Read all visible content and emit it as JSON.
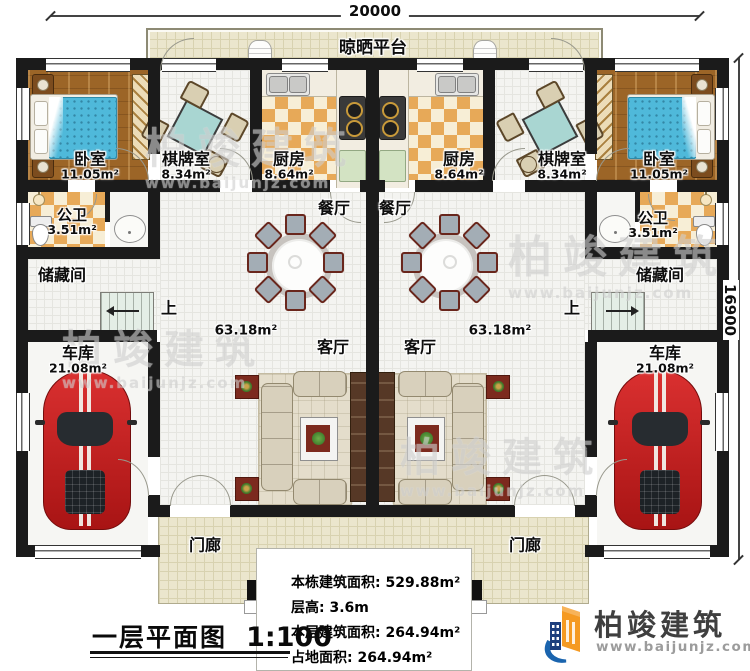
{
  "dimensions": {
    "top": "20000",
    "right": "16900"
  },
  "platform": {
    "label": "晾晒平台"
  },
  "rooms": {
    "bedroom": {
      "name": "卧室",
      "area": "11.05m²"
    },
    "chess": {
      "name": "棋牌室",
      "area": "8.34m²"
    },
    "kitchen": {
      "name": "厨房",
      "area": "8.64m²"
    },
    "bath": {
      "name": "公卫",
      "area": "3.51m²"
    },
    "storage": {
      "name": "储藏间"
    },
    "garage": {
      "name": "车库",
      "area": "21.08m²"
    },
    "dining": {
      "name": "餐厅"
    },
    "living": {
      "name": "客厅",
      "area": "63.18m²"
    },
    "porch": {
      "name": "门廊"
    },
    "stairs": {
      "up": "上"
    }
  },
  "title_block": {
    "title": "一层平面图",
    "scale": "1:100"
  },
  "stats": [
    {
      "label": "本栋建筑面积:",
      "value": "529.88m²"
    },
    {
      "label": "层高:",
      "value": "3.6m"
    },
    {
      "label": "本层建筑面积:",
      "value": "264.94m²"
    },
    {
      "label": "占地面积:",
      "value": "264.94m²"
    }
  ],
  "brand": {
    "name": "柏竣建筑",
    "url": "www.baijunjz.com"
  },
  "watermark": {
    "text": "柏竣建筑",
    "url": "www.baijunjz.com"
  },
  "colors": {
    "wall": "#1b1b1b",
    "brand_blue": "#1a64ae",
    "brand_orange": "#f59a22",
    "car_red": "#c92121",
    "tile": "#e7a958"
  }
}
